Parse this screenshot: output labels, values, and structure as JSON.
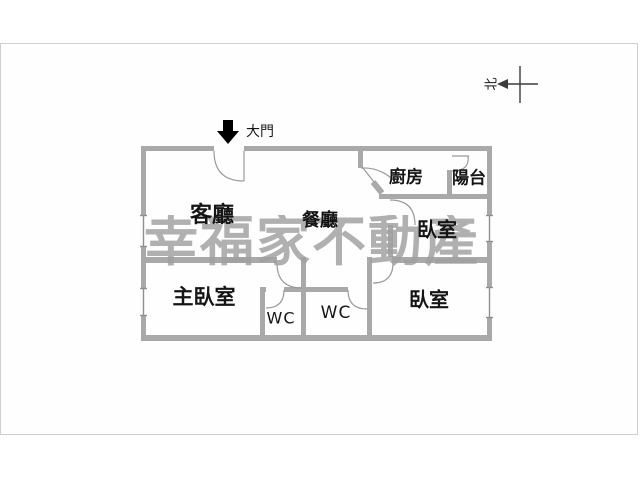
{
  "floorplan": {
    "title": "apartment-floor-plan",
    "rooms": [
      {
        "id": "living-room",
        "label": "客廳"
      },
      {
        "id": "dining-room",
        "label": "餐廳"
      },
      {
        "id": "kitchen",
        "label": "廚房"
      },
      {
        "id": "balcony",
        "label": "陽台"
      },
      {
        "id": "bedroom-upper",
        "label": "臥室"
      },
      {
        "id": "master-bedroom",
        "label": "主臥室"
      },
      {
        "id": "wc-1",
        "label": "WC"
      },
      {
        "id": "wc-2",
        "label": "WC"
      },
      {
        "id": "bedroom-lower",
        "label": "臥室"
      }
    ],
    "entrance": {
      "label": "大門"
    },
    "compass": {
      "label": "北"
    },
    "watermark": {
      "text": "幸福家不動產",
      "color": "#a0a0a0"
    },
    "colors": {
      "wall": "#a9a9a9",
      "wall_edge": "#8f8f8f",
      "door_arc": "#9a9a9a",
      "frame_border": "#cfcfcf",
      "text": "#151515",
      "entrance_arrow": "#000000"
    }
  }
}
